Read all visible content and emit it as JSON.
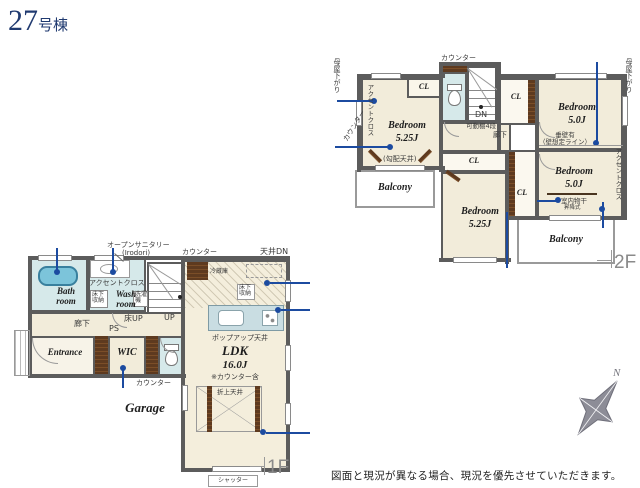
{
  "page": {
    "title_number": "27",
    "title_suffix": "号棟",
    "disclaimer": "図面と現況が異なる場合、現況を優先させていただきます。",
    "floor1_label": "1F",
    "floor2_label": "2F",
    "compass_north": "N"
  },
  "colors": {
    "title_navy": "#203a70",
    "wall_gray": "#5c5c5c",
    "floor_cream": "#f2ecda",
    "water_blue": "#d6e9ea",
    "tub_blue": "#7cc4da",
    "island_blue": "#c9dde2",
    "wood_brown": "#5e3a1f",
    "pin_navy": "#1c4ba0",
    "compass_gray": "#8d8d97"
  },
  "floor1": {
    "rooms": {
      "bath": "Bath room",
      "wash": "Wash room",
      "entrance": "Entrance",
      "wic": "WIC",
      "garage": "Garage",
      "ldk": "LDK",
      "ldk_size": "16.0J",
      "ldk_note": "※カウンター含"
    },
    "labels": {
      "open_sanitary": "オープンサニタリー",
      "open_sanitary_sub": "(Irodori)",
      "accent_cloth": "アクセントクロス",
      "underfloor_storage": "床下収納",
      "washer": "洗濯機",
      "hallway": "廊下",
      "ps": "PS",
      "floor_up": "床UP",
      "up": "UP",
      "counter_wic": "カウンター",
      "counter_kitchen": "カウンター",
      "ceiling_down": "天井DN",
      "fridge": "冷蔵庫",
      "underfloor_storage2": "床下収納",
      "popup_ceiling": "ポップアップ天井",
      "coffered_ceiling": "折上天井",
      "shutter": "シャッター"
    }
  },
  "floor2": {
    "rooms": {
      "closet": "CL",
      "bedroom_tl": "Bedroom",
      "bedroom_tl_size": "5.25J",
      "bedroom_tl_note": "(勾配天井)",
      "bedroom_tr": "Bedroom",
      "bedroom_tr_size": "5.0J",
      "bedroom_mid": "Bedroom",
      "bedroom_mid_size": "5.25J",
      "bedroom_br": "Bedroom",
      "bedroom_br_size": "5.0J",
      "balcony_left": "Balcony",
      "balcony_right": "Balcony"
    },
    "labels": {
      "moya_left": "母屋下がり",
      "moya_right": "母屋下がり",
      "accent_tl": "アクセントクロス",
      "accent_tr": "アクセントクロス",
      "counter_left": "カウンター",
      "counter_top": "カウンター",
      "dn": "DN",
      "shelf": "可動棚4段",
      "hallway": "廊下",
      "tarekabe": "垂壁有",
      "tarekabe_sub": "（壁想定ライン）",
      "monohoshi": "室内物干",
      "monohoshi_sub": "昇降式"
    }
  }
}
